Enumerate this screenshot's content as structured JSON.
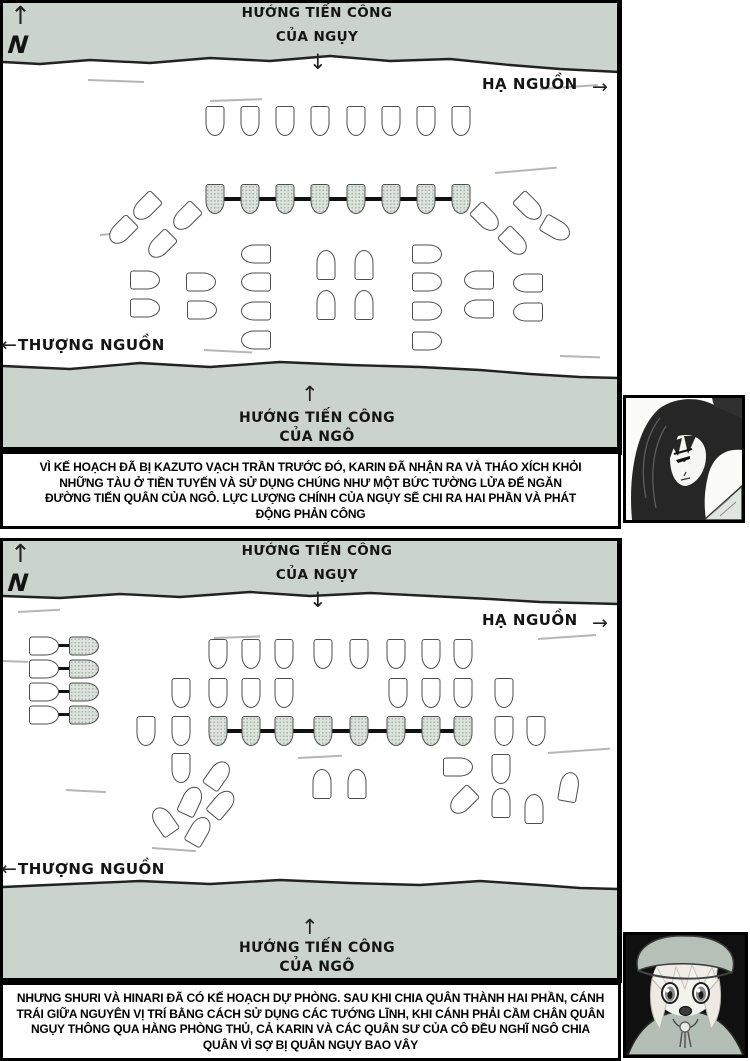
{
  "icons": {
    "up": "↑",
    "down": "↓",
    "left": "←",
    "right": "→"
  },
  "colors": {
    "shore": "#cad3cc",
    "river": "#ffffff",
    "ship_fill": "#ffffff",
    "ship_shaded_fill": "#dce2dc",
    "ship_outline": "#4d4d4d",
    "chain": "#101010",
    "border": "#000000",
    "text": "#141414"
  },
  "panel1": {
    "compass": "N",
    "attack_top": [
      "HƯỚNG TIẾN CÔNG",
      "CỦA NGỤY"
    ],
    "downstream": "HẠ NGUỒN",
    "upstream": "THƯỢNG NGUỒN",
    "attack_bottom": [
      "HƯỚNG TIẾN CÔNG",
      "CỦA NGÔ"
    ],
    "ships": [
      [
        215,
        121,
        180,
        "w"
      ],
      [
        250,
        121,
        180,
        "w"
      ],
      [
        285,
        121,
        180,
        "w"
      ],
      [
        320,
        121,
        180,
        "w"
      ],
      [
        356,
        121,
        180,
        "w"
      ],
      [
        391,
        121,
        180,
        "w"
      ],
      [
        426,
        121,
        180,
        "w"
      ],
      [
        461,
        121,
        180,
        "w"
      ],
      [
        215,
        199,
        180,
        "s"
      ],
      [
        250,
        199,
        180,
        "s"
      ],
      [
        285,
        199,
        180,
        "s"
      ],
      [
        320,
        199,
        180,
        "s"
      ],
      [
        356,
        199,
        180,
        "s"
      ],
      [
        391,
        199,
        180,
        "s"
      ],
      [
        426,
        199,
        180,
        "s"
      ],
      [
        461,
        199,
        180,
        "s"
      ],
      [
        146,
        207,
        225,
        "w"
      ],
      [
        186,
        217,
        225,
        "w"
      ],
      [
        122,
        231,
        225,
        "w"
      ],
      [
        161,
        245,
        225,
        "w"
      ],
      [
        529,
        207,
        135,
        "w"
      ],
      [
        486,
        218,
        135,
        "w"
      ],
      [
        556,
        229,
        120,
        "w"
      ],
      [
        514,
        242,
        135,
        "w"
      ],
      [
        145,
        280,
        90,
        "w"
      ],
      [
        201,
        282,
        90,
        "w"
      ],
      [
        145,
        308,
        90,
        "w"
      ],
      [
        202,
        310,
        90,
        "w"
      ],
      [
        256,
        254,
        270,
        "w"
      ],
      [
        256,
        282,
        270,
        "w"
      ],
      [
        256,
        311,
        270,
        "w"
      ],
      [
        256,
        340,
        270,
        "w"
      ],
      [
        326,
        265,
        0,
        "w"
      ],
      [
        364,
        265,
        0,
        "w"
      ],
      [
        326,
        305,
        0,
        "w"
      ],
      [
        364,
        305,
        0,
        "w"
      ],
      [
        427,
        254,
        90,
        "w"
      ],
      [
        427,
        282,
        90,
        "w"
      ],
      [
        427,
        311,
        90,
        "w"
      ],
      [
        427,
        341,
        90,
        "w"
      ],
      [
        479,
        280,
        270,
        "w"
      ],
      [
        528,
        283,
        270,
        "w"
      ],
      [
        479,
        309,
        270,
        "w"
      ],
      [
        528,
        312,
        270,
        "w"
      ]
    ],
    "chains": [
      [
        213,
        197,
        250,
        4
      ]
    ],
    "scratches": [
      [
        88,
        79,
        56,
        2
      ],
      [
        210,
        100,
        52,
        -2
      ],
      [
        540,
        88,
        58,
        -4
      ],
      [
        100,
        234,
        32,
        -6
      ],
      [
        204,
        349,
        48,
        3
      ],
      [
        495,
        172,
        62,
        -5
      ],
      [
        560,
        355,
        40,
        2
      ]
    ]
  },
  "panel2": {
    "compass": "N",
    "attack_top": [
      "HƯỚNG TIẾN CÔNG",
      "CỦA NGỤY"
    ],
    "downstream": "HẠ NGUỒN",
    "upstream": "THƯỢNG NGUỒN",
    "attack_bottom": [
      "HƯỚNG TIẾN CÔNG",
      "CỦA NGÔ"
    ],
    "ships": [
      [
        44,
        646,
        90,
        "w"
      ],
      [
        84,
        646,
        90,
        "s"
      ],
      [
        44,
        669,
        90,
        "w"
      ],
      [
        84,
        669,
        90,
        "s"
      ],
      [
        44,
        692,
        90,
        "w"
      ],
      [
        84,
        692,
        90,
        "s"
      ],
      [
        44,
        715,
        90,
        "w"
      ],
      [
        84,
        715,
        90,
        "s"
      ],
      [
        218,
        654,
        180,
        "w"
      ],
      [
        251,
        654,
        180,
        "w"
      ],
      [
        284,
        654,
        180,
        "w"
      ],
      [
        323,
        654,
        180,
        "w"
      ],
      [
        359,
        654,
        180,
        "w"
      ],
      [
        396,
        654,
        180,
        "w"
      ],
      [
        431,
        654,
        180,
        "w"
      ],
      [
        463,
        654,
        180,
        "w"
      ],
      [
        181,
        693,
        180,
        "w"
      ],
      [
        218,
        693,
        180,
        "w"
      ],
      [
        251,
        693,
        180,
        "w"
      ],
      [
        284,
        693,
        180,
        "w"
      ],
      [
        398,
        693,
        180,
        "w"
      ],
      [
        431,
        693,
        180,
        "w"
      ],
      [
        463,
        693,
        180,
        "w"
      ],
      [
        504,
        693,
        180,
        "w"
      ],
      [
        146,
        731,
        180,
        "w"
      ],
      [
        181,
        731,
        180,
        "w"
      ],
      [
        504,
        731,
        180,
        "w"
      ],
      [
        536,
        731,
        180,
        "w"
      ],
      [
        218,
        731,
        180,
        "s"
      ],
      [
        251,
        731,
        180,
        "s"
      ],
      [
        284,
        731,
        180,
        "s"
      ],
      [
        323,
        731,
        180,
        "s"
      ],
      [
        359,
        731,
        180,
        "s"
      ],
      [
        396,
        731,
        180,
        "s"
      ],
      [
        431,
        731,
        180,
        "s"
      ],
      [
        463,
        731,
        180,
        "s"
      ],
      [
        181,
        768,
        180,
        "w"
      ],
      [
        218,
        775,
        35,
        "w"
      ],
      [
        191,
        801,
        25,
        "w"
      ],
      [
        222,
        804,
        40,
        "w"
      ],
      [
        164,
        821,
        -35,
        "w"
      ],
      [
        199,
        831,
        30,
        "w"
      ],
      [
        322,
        784,
        0,
        "w"
      ],
      [
        357,
        784,
        0,
        "w"
      ],
      [
        458,
        767,
        90,
        "w"
      ],
      [
        501,
        769,
        180,
        "w"
      ],
      [
        463,
        801,
        225,
        "w"
      ],
      [
        501,
        803,
        0,
        "w"
      ],
      [
        534,
        809,
        0,
        "w"
      ],
      [
        569,
        787,
        10,
        "w"
      ]
    ],
    "chains": [
      [
        216,
        729,
        249,
        4
      ],
      [
        55,
        644,
        19,
        3
      ],
      [
        55,
        667,
        19,
        3
      ],
      [
        55,
        690,
        19,
        3
      ],
      [
        55,
        713,
        19,
        3
      ]
    ],
    "scratches": [
      [
        18,
        611,
        42,
        -3
      ],
      [
        214,
        637,
        46,
        -2
      ],
      [
        538,
        638,
        58,
        -4
      ],
      [
        298,
        757,
        44,
        -3
      ],
      [
        66,
        789,
        40,
        3
      ],
      [
        152,
        847,
        44,
        4
      ],
      [
        548,
        752,
        62,
        -4
      ],
      [
        2,
        660,
        26,
        2
      ]
    ]
  },
  "caption1": {
    "lines": [
      "VÌ KẾ HOẠCH ĐÃ BỊ KAZUTO VẠCH TRẦN TRƯỚC ĐÓ, KARIN ĐÃ NHẬN RA VÀ THÁO XÍCH KHỎI",
      "NHỮNG TÀU Ở TIỀN TUYẾN VÀ SỬ DỤNG  CHÚNG NHƯ MỘT BỨC TƯỜNG LỬA ĐỂ NGĂN",
      "ĐƯỜNG  TIẾN QUÂN CỦA NGÔ. LỰC LƯỢNG CHÍNH CỦA NGỤY SẼ CHI RA HAI PHẦN VÀ PHÁT",
      "ĐỘNG PHẢN CÔNG"
    ]
  },
  "caption2": {
    "lines": [
      "NHƯNG SHURI VÀ HINARI ĐÃ CÓ KẾ HOẠCH DỰ PHÒNG. SAU KHI CHIA QUÂN THÀNH HAI PHẦN, CÁNH",
      "TRÁI GIỮA NGUYÊN VỊ TRÍ BẰNG CÁCH SỬ DỤNG CÁC TƯỚNG LĨNH, KHI CÁNH PHẢI CẦM CHÂN QUÂN",
      "NGỤY  THÔNG QUA HÀNG PHÒNG THỦ, CẢ KARIN VÀ CÁC QUÂN SƯ CỦA CÔ ĐỀU NGHĨ NGÔ CHIA",
      "QUÂN VÌ SỢ BỊ QUÂN NGỤY BAO VÂY"
    ]
  }
}
